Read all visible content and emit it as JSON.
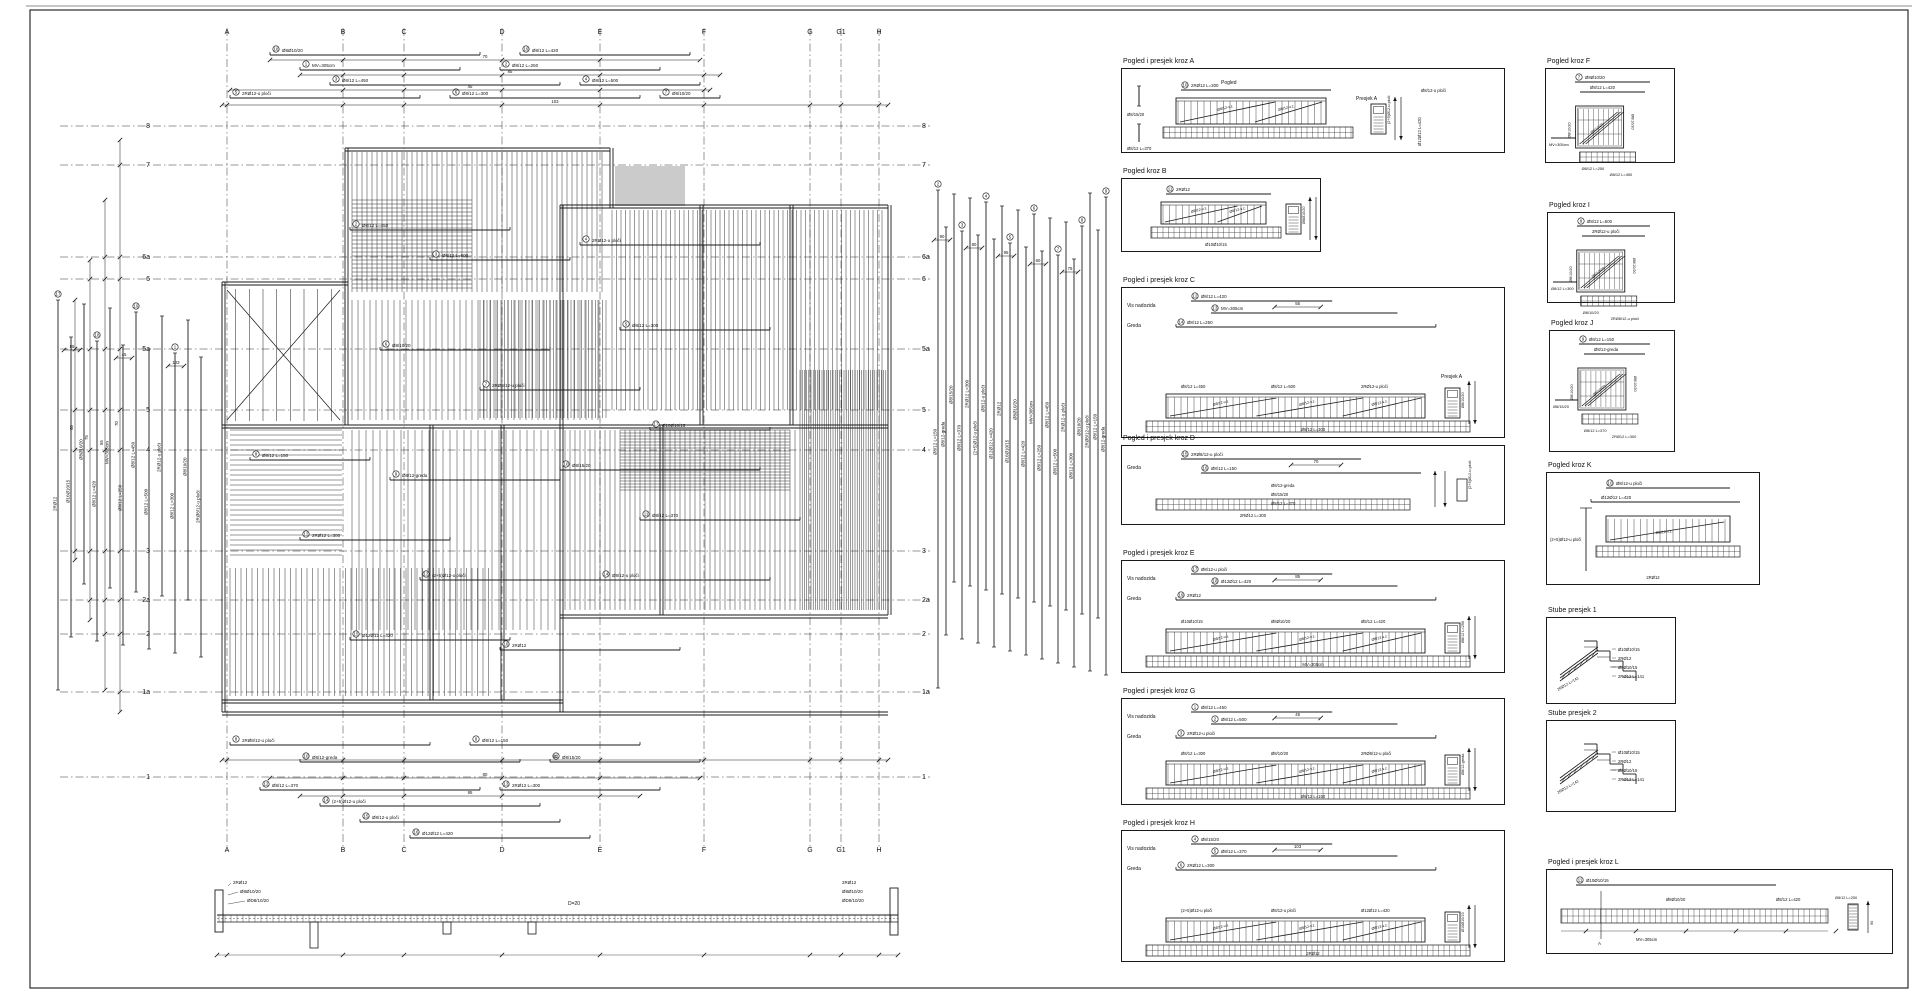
{
  "sheet": {
    "w": 1920,
    "h": 999,
    "bg": "#ffffff",
    "line_color": "#1a1a1a",
    "frame": [
      30,
      10,
      1878,
      978
    ]
  },
  "labels": {
    "pogled": "Pogled",
    "presjek_a": "Presjek A",
    "vis_nadozida": "Vis nadozida",
    "greda": "Greda",
    "d_label": "D=20",
    "section_a_mark": "A"
  },
  "label_pool": [
    "Ø8/12 L=450",
    "Ø8/12 L=500",
    "2RØ12-u ploči",
    "Ø8/12 L=300",
    "Ø8/10/20",
    "2RØ8/12-u ploči",
    "Ø8/12 L=150",
    "Ø8/12-greda",
    "Ø8/15/20",
    "Ø8/12 L=370",
    "2RØ12 L=300",
    "(2+5)Ø12-u ploči",
    "Ø8/12-u ploči",
    "Ø12Ø12 L=420",
    "2RØ12",
    "Ø10Ø10/15",
    "Ø8Ø10/20",
    "Ø8/12 L=420",
    "MV=305cm",
    "Ø8/12 L=250"
  ],
  "dim_pool": [
    "70",
    "85",
    "45",
    "103",
    "90",
    "80",
    "95",
    "60",
    "75",
    "55"
  ],
  "stair_labels": [
    "Ø10Ø10/15",
    "2RØ12",
    "Ø8Ø10/15",
    "2RØ12 L=141"
  ],
  "bottom_left_labels": [
    "2RØ12",
    "Ø8Ø10/20",
    "ØD8/10/20"
  ],
  "plan": {
    "grid_cols": [
      {
        "label": "A",
        "x": 227
      },
      {
        "label": "B",
        "x": 343
      },
      {
        "label": "C",
        "x": 404
      },
      {
        "label": "D",
        "x": 502
      },
      {
        "label": "E",
        "x": 600
      },
      {
        "label": "F",
        "x": 704
      },
      {
        "label": "G",
        "x": 810
      },
      {
        "label": "G1",
        "x": 841
      },
      {
        "label": "H",
        "x": 879
      }
    ],
    "grid_rows": [
      {
        "label": "8",
        "y": 126
      },
      {
        "label": "7",
        "y": 165
      },
      {
        "label": "6a",
        "y": 257
      },
      {
        "label": "6",
        "y": 279
      },
      {
        "label": "5a",
        "y": 349
      },
      {
        "label": "5",
        "y": 410
      },
      {
        "label": "4",
        "y": 450
      },
      {
        "label": "3",
        "y": 551
      },
      {
        "label": "2a",
        "y": 600
      },
      {
        "label": "2",
        "y": 634
      },
      {
        "label": "1a",
        "y": 692
      },
      {
        "label": "1",
        "y": 777
      }
    ],
    "grid_y": [
      28,
      850
    ],
    "grid_x": [
      60,
      930
    ],
    "col_label_y": [
      34,
      846
    ],
    "row_label_x": [
      150,
      922
    ],
    "walls_h": [
      [
        345,
        148,
        610
      ],
      [
        560,
        205,
        888
      ],
      [
        222,
        282,
        348
      ],
      [
        222,
        425,
        888
      ],
      [
        560,
        615,
        888
      ],
      [
        222,
        700,
        563
      ],
      [
        222,
        712,
        888
      ]
    ],
    "walls_v": [
      [
        222,
        282,
        712
      ],
      [
        345,
        148,
        425
      ],
      [
        610,
        148,
        208
      ],
      [
        560,
        205,
        712
      ],
      [
        888,
        205,
        615
      ],
      [
        430,
        425,
        700
      ],
      [
        501,
        425,
        700
      ],
      [
        700,
        205,
        425
      ],
      [
        790,
        205,
        425
      ],
      [
        660,
        425,
        615
      ]
    ],
    "stair": {
      "x": 222,
      "y": 285,
      "w": 123,
      "h": 140,
      "treads": 8
    },
    "hatches": [
      [
        352,
        152,
        254,
        140,
        5,
        1
      ],
      [
        612,
        210,
        272,
        200,
        4.5,
        1
      ],
      [
        800,
        370,
        86,
        240,
        2.2,
        1
      ],
      [
        616,
        166,
        68,
        40,
        2,
        1
      ],
      [
        352,
        300,
        250,
        120,
        6,
        1
      ],
      [
        480,
        300,
        128,
        118,
        3.5,
        1
      ],
      [
        230,
        430,
        112,
        125,
        5,
        0
      ],
      [
        352,
        430,
        205,
        200,
        7,
        1
      ],
      [
        230,
        568,
        262,
        128,
        5.5,
        1
      ],
      [
        565,
        430,
        230,
        180,
        5,
        1
      ],
      [
        620,
        430,
        170,
        60,
        3,
        0
      ],
      [
        352,
        200,
        120,
        90,
        4,
        0
      ]
    ],
    "bars": [
      [
        350,
        230,
        160
      ],
      [
        430,
        260,
        140
      ],
      [
        580,
        245,
        180
      ],
      [
        620,
        330,
        150
      ],
      [
        380,
        350,
        170
      ],
      [
        480,
        390,
        160
      ],
      [
        250,
        460,
        120
      ],
      [
        390,
        480,
        170
      ],
      [
        560,
        470,
        200
      ],
      [
        640,
        520,
        160
      ],
      [
        300,
        540,
        150
      ],
      [
        420,
        580,
        180
      ],
      [
        600,
        580,
        170
      ],
      [
        350,
        640,
        160
      ],
      [
        500,
        650,
        180
      ],
      [
        650,
        430,
        120
      ]
    ],
    "top_bars": [
      [
        270,
        55,
        210
      ],
      [
        520,
        55,
        170
      ],
      [
        300,
        70,
        160
      ],
      [
        500,
        70,
        160
      ],
      [
        330,
        85,
        230
      ],
      [
        580,
        85,
        120
      ],
      [
        230,
        98,
        190
      ],
      [
        450,
        98,
        190
      ],
      [
        660,
        98,
        60
      ]
    ],
    "bottom_bars": [
      [
        230,
        745,
        200
      ],
      [
        470,
        745,
        170
      ],
      [
        300,
        762,
        220
      ],
      [
        550,
        762,
        150
      ],
      [
        260,
        790,
        220
      ],
      [
        500,
        790,
        160
      ],
      [
        320,
        806,
        220
      ],
      [
        360,
        822,
        200
      ],
      [
        410,
        838,
        180
      ]
    ],
    "top_chains": [
      {
        "y": 60,
        "x1": 270,
        "x2": 700
      },
      {
        "y": 75,
        "x1": 300,
        "x2": 720
      },
      {
        "y": 90,
        "x1": 230,
        "x2": 710
      },
      {
        "y": 105,
        "x1": 222,
        "x2": 888
      }
    ],
    "bottom_chains": [
      {
        "y": 760,
        "x1": 222,
        "x2": 888
      },
      {
        "y": 778,
        "x1": 270,
        "x2": 700
      },
      {
        "y": 796,
        "x1": 300,
        "x2": 640
      }
    ],
    "left_chains": [
      {
        "x": 75,
        "y1": 300,
        "y2": 560
      },
      {
        "x": 90,
        "y1": 260,
        "y2": 620
      },
      {
        "x": 105,
        "y1": 200,
        "y2": 690
      },
      {
        "x": 120,
        "y1": 140,
        "y2": 712
      }
    ],
    "strip_left": {
      "x0": 58,
      "dx": 13,
      "n": 12,
      "y1": 300,
      "y2": 690
    },
    "strip_right": {
      "x0": 938,
      "dx": 8,
      "n": 22,
      "y1": 190,
      "y2": 688
    }
  },
  "detail_boxes": [
    {
      "title": "Pogled i presjek kroz A",
      "x": 1121,
      "y": 68,
      "w": 384,
      "h": 85,
      "kind": "beamA"
    },
    {
      "title": "Pogled kroz B",
      "x": 1121,
      "y": 178,
      "w": 200,
      "h": 74,
      "kind": "beamB"
    },
    {
      "title": "Pogled i presjek kroz C",
      "x": 1121,
      "y": 287,
      "w": 384,
      "h": 151,
      "kind": "beam"
    },
    {
      "title": "Pogled i presjek kroz D",
      "x": 1121,
      "y": 445,
      "w": 384,
      "h": 80,
      "kind": "beamD"
    },
    {
      "title": "Pogled i presjek kroz E",
      "x": 1121,
      "y": 560,
      "w": 384,
      "h": 113,
      "kind": "beam"
    },
    {
      "title": "Pogled i presjek kroz G",
      "x": 1121,
      "y": 698,
      "w": 384,
      "h": 107,
      "kind": "beam"
    },
    {
      "title": "Pogled i presjek kroz H",
      "x": 1121,
      "y": 830,
      "w": 384,
      "h": 132,
      "kind": "beam"
    },
    {
      "title": "Pogled kroz F",
      "x": 1545,
      "y": 68,
      "w": 130,
      "h": 95,
      "kind": "panel"
    },
    {
      "title": "Pogled kroz I",
      "x": 1547,
      "y": 212,
      "w": 128,
      "h": 91,
      "kind": "panel"
    },
    {
      "title": "Pogled kroz J",
      "x": 1549,
      "y": 330,
      "w": 126,
      "h": 122,
      "kind": "panel"
    },
    {
      "title": "Pogled kroz K",
      "x": 1546,
      "y": 472,
      "w": 214,
      "h": 113,
      "kind": "beamK"
    },
    {
      "title": "Stube presjek 1",
      "x": 1546,
      "y": 617,
      "w": 130,
      "h": 87,
      "kind": "stair"
    },
    {
      "title": "Stube presjek 2",
      "x": 1546,
      "y": 720,
      "w": 130,
      "h": 92,
      "kind": "stair"
    },
    {
      "title": "Pogled i presjek kroz L",
      "x": 1546,
      "y": 869,
      "w": 347,
      "h": 85,
      "kind": "beamL"
    }
  ],
  "bottom_section": {
    "slab": {
      "x1": 217,
      "x2": 898,
      "y1": 915,
      "y2": 922
    },
    "left_wall": [
      215,
      890,
      8,
      42
    ],
    "right_wall": [
      890,
      888,
      8,
      47
    ],
    "beams": [
      [
        310,
        922,
        8,
        26
      ],
      [
        443,
        922,
        8,
        12
      ],
      [
        528,
        922,
        8,
        12
      ]
    ],
    "label_pos": [
      568,
      905
    ]
  }
}
